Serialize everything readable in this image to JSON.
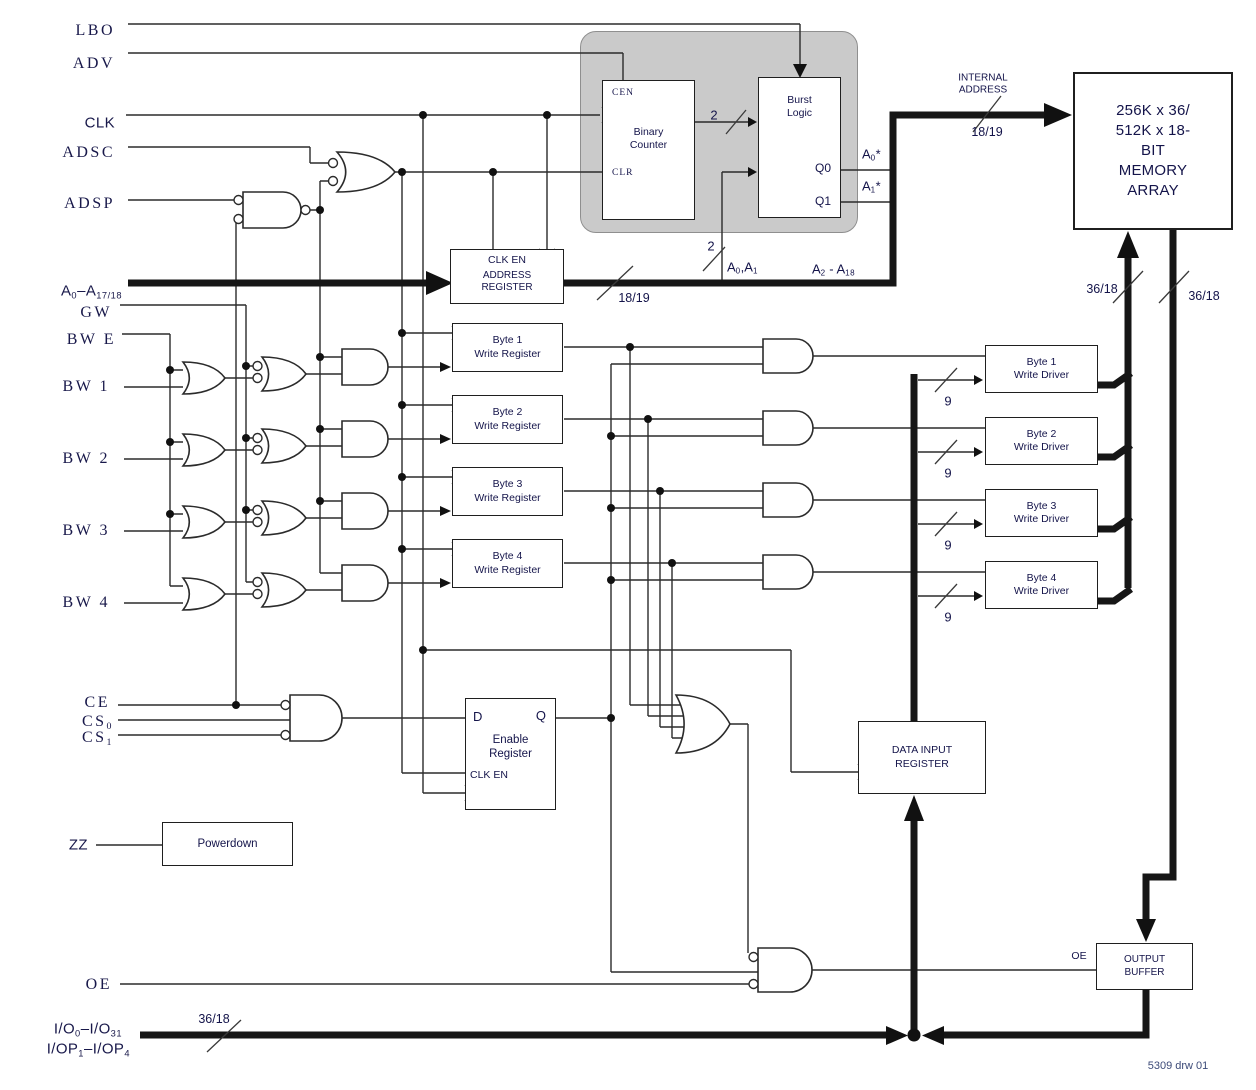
{
  "diagram_title": "Synchronous SRAM functional block diagram",
  "signals": {
    "lbo": {
      "parts": [
        {
          "t": "LBO"
        }
      ]
    },
    "adv": {
      "parts": [
        {
          "t": "ADV"
        }
      ]
    },
    "clk": {
      "parts": [
        {
          "t": "CLK"
        }
      ],
      "font": "sans"
    },
    "adsc": {
      "parts": [
        {
          "t": "ADSC"
        }
      ]
    },
    "adsp": {
      "parts": [
        {
          "t": "ADSP"
        }
      ]
    },
    "abus": {
      "parts": [
        {
          "t": "A"
        },
        {
          "t": "0",
          "sub": true
        },
        {
          "t": "–A"
        },
        {
          "t": "17/18",
          "sub": true
        }
      ],
      "font": "sans"
    },
    "gw": {
      "parts": [
        {
          "t": "GW"
        }
      ]
    },
    "bwe": {
      "parts": [
        {
          "t": "BW E"
        }
      ]
    },
    "bw1": {
      "parts": [
        {
          "t": "BW 1"
        }
      ]
    },
    "bw2": {
      "parts": [
        {
          "t": "BW 2"
        }
      ]
    },
    "bw3": {
      "parts": [
        {
          "t": "BW 3"
        }
      ]
    },
    "bw4": {
      "parts": [
        {
          "t": "BW 4"
        }
      ]
    },
    "ce": {
      "parts": [
        {
          "t": "CE"
        }
      ]
    },
    "cs0": {
      "parts": [
        {
          "t": "CS"
        },
        {
          "t": "0",
          "sub": true
        }
      ]
    },
    "cs1": {
      "parts": [
        {
          "t": "CS"
        },
        {
          "t": "1",
          "sub": true
        }
      ]
    },
    "zz": {
      "parts": [
        {
          "t": "ZZ"
        }
      ],
      "font": "sans"
    },
    "oe": {
      "parts": [
        {
          "t": "OE"
        }
      ]
    },
    "io1": {
      "parts": [
        {
          "t": "I/O"
        },
        {
          "t": "0",
          "sub": true
        },
        {
          "t": "–I/O"
        },
        {
          "t": "31",
          "sub": true
        }
      ],
      "font": "sans"
    },
    "io2": {
      "parts": [
        {
          "t": "I/OP"
        },
        {
          "t": "1",
          "sub": true
        },
        {
          "t": "–I/OP"
        },
        {
          "t": "4",
          "sub": true
        }
      ],
      "font": "sans"
    }
  },
  "taps": {
    "a0a1": {
      "parts": [
        {
          "t": "A"
        },
        {
          "t": "0",
          "sub": true
        },
        {
          "t": ",A"
        },
        {
          "t": "1",
          "sub": true
        }
      ]
    },
    "a2a18": {
      "parts": [
        {
          "t": "A"
        },
        {
          "t": "2",
          "sub": true
        },
        {
          "t": " - A"
        },
        {
          "t": "18",
          "sub": true
        }
      ]
    },
    "a0star": {
      "parts": [
        {
          "t": "A"
        },
        {
          "t": "0",
          "sub": true
        },
        {
          "t": "*"
        }
      ]
    },
    "a1star": {
      "parts": [
        {
          "t": "A"
        },
        {
          "t": "1",
          "sub": true
        },
        {
          "t": "*"
        }
      ]
    }
  },
  "blocks": {
    "binary_counter": {
      "cen": "CEN",
      "clr": "CLR",
      "line1": "Binary",
      "line2": "Counter"
    },
    "burst_logic": {
      "line1": "Burst",
      "line2": "Logic",
      "q0": "Q0",
      "q1": "Q1"
    },
    "address_register": {
      "clk_en": "CLK EN",
      "line1": "ADDRESS",
      "line2": "REGISTER"
    },
    "memory_array": {
      "lines": [
        "256K x 36/",
        "512K x 18-",
        "BIT",
        "MEMORY",
        "ARRAY"
      ]
    },
    "write_registers": [
      {
        "line1": "Byte 1",
        "line2": "Write Register"
      },
      {
        "line1": "Byte 2",
        "line2": "Write Register"
      },
      {
        "line1": "Byte 3",
        "line2": "Write Register"
      },
      {
        "line1": "Byte 4",
        "line2": "Write Register"
      }
    ],
    "write_drivers": [
      {
        "line1": "Byte 1",
        "line2": "Write Driver"
      },
      {
        "line1": "Byte 2",
        "line2": "Write Driver"
      },
      {
        "line1": "Byte 3",
        "line2": "Write Driver"
      },
      {
        "line1": "Byte 4",
        "line2": "Write Driver"
      }
    ],
    "enable_register": {
      "d": "D",
      "q": "Q",
      "line1": "Enable",
      "line2": "Register",
      "clk_en": "CLK EN"
    },
    "data_input_register": {
      "line1": "DATA INPUT",
      "line2": "REGISTER"
    },
    "powerdown": {
      "label": "Powerdown"
    },
    "output_buffer": {
      "oe": "OE",
      "line1": "OUTPUT",
      "line2": "BUFFER"
    }
  },
  "labels": {
    "internal_address": [
      "INTERNAL",
      "ADDRESS"
    ]
  },
  "widths": {
    "internal": "18/19",
    "addr_out": "18/19",
    "counter": "2",
    "tap": "2",
    "array_in": "36/18",
    "array_out": "36/18",
    "io": "36/18",
    "byte": "9"
  },
  "footer": {
    "drawing_number": "5309 drw 01"
  }
}
